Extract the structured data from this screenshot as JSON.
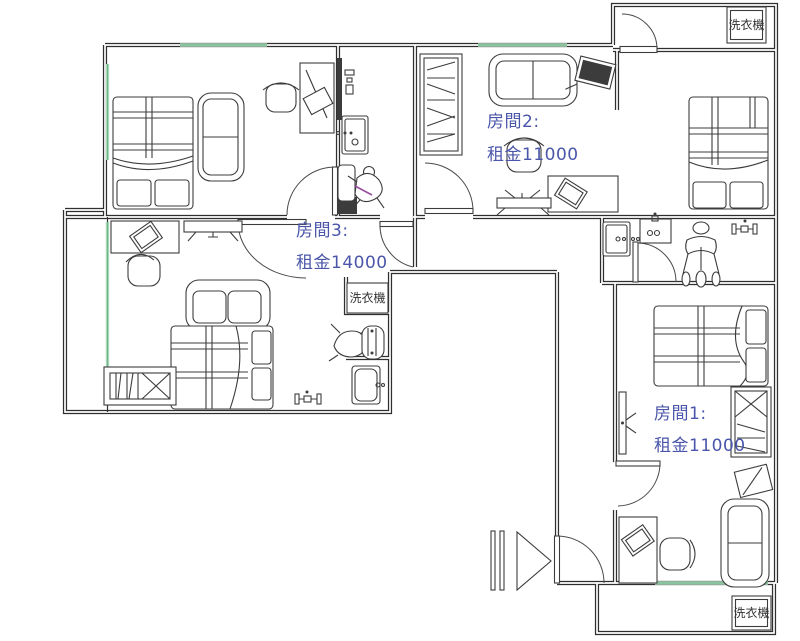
{
  "plan": {
    "rooms": [
      {
        "id": "room-1",
        "label": "房間1:",
        "rent": "租金11000"
      },
      {
        "id": "room-2",
        "label": "房間2:",
        "rent": "租金11000"
      },
      {
        "id": "room-3",
        "label": "房間3:",
        "rent": "租金14000"
      }
    ],
    "washing_machines": [
      {
        "label": "洗衣機"
      },
      {
        "label": "洗衣機"
      },
      {
        "label": "洗衣機"
      }
    ],
    "colors": {
      "wall": "#2f2f2f",
      "furniture": "#3c3c3c",
      "window_green": "#6fb58a",
      "room_label": "#4a56aa",
      "washer_label": "#333333",
      "background": "#ffffff"
    }
  }
}
